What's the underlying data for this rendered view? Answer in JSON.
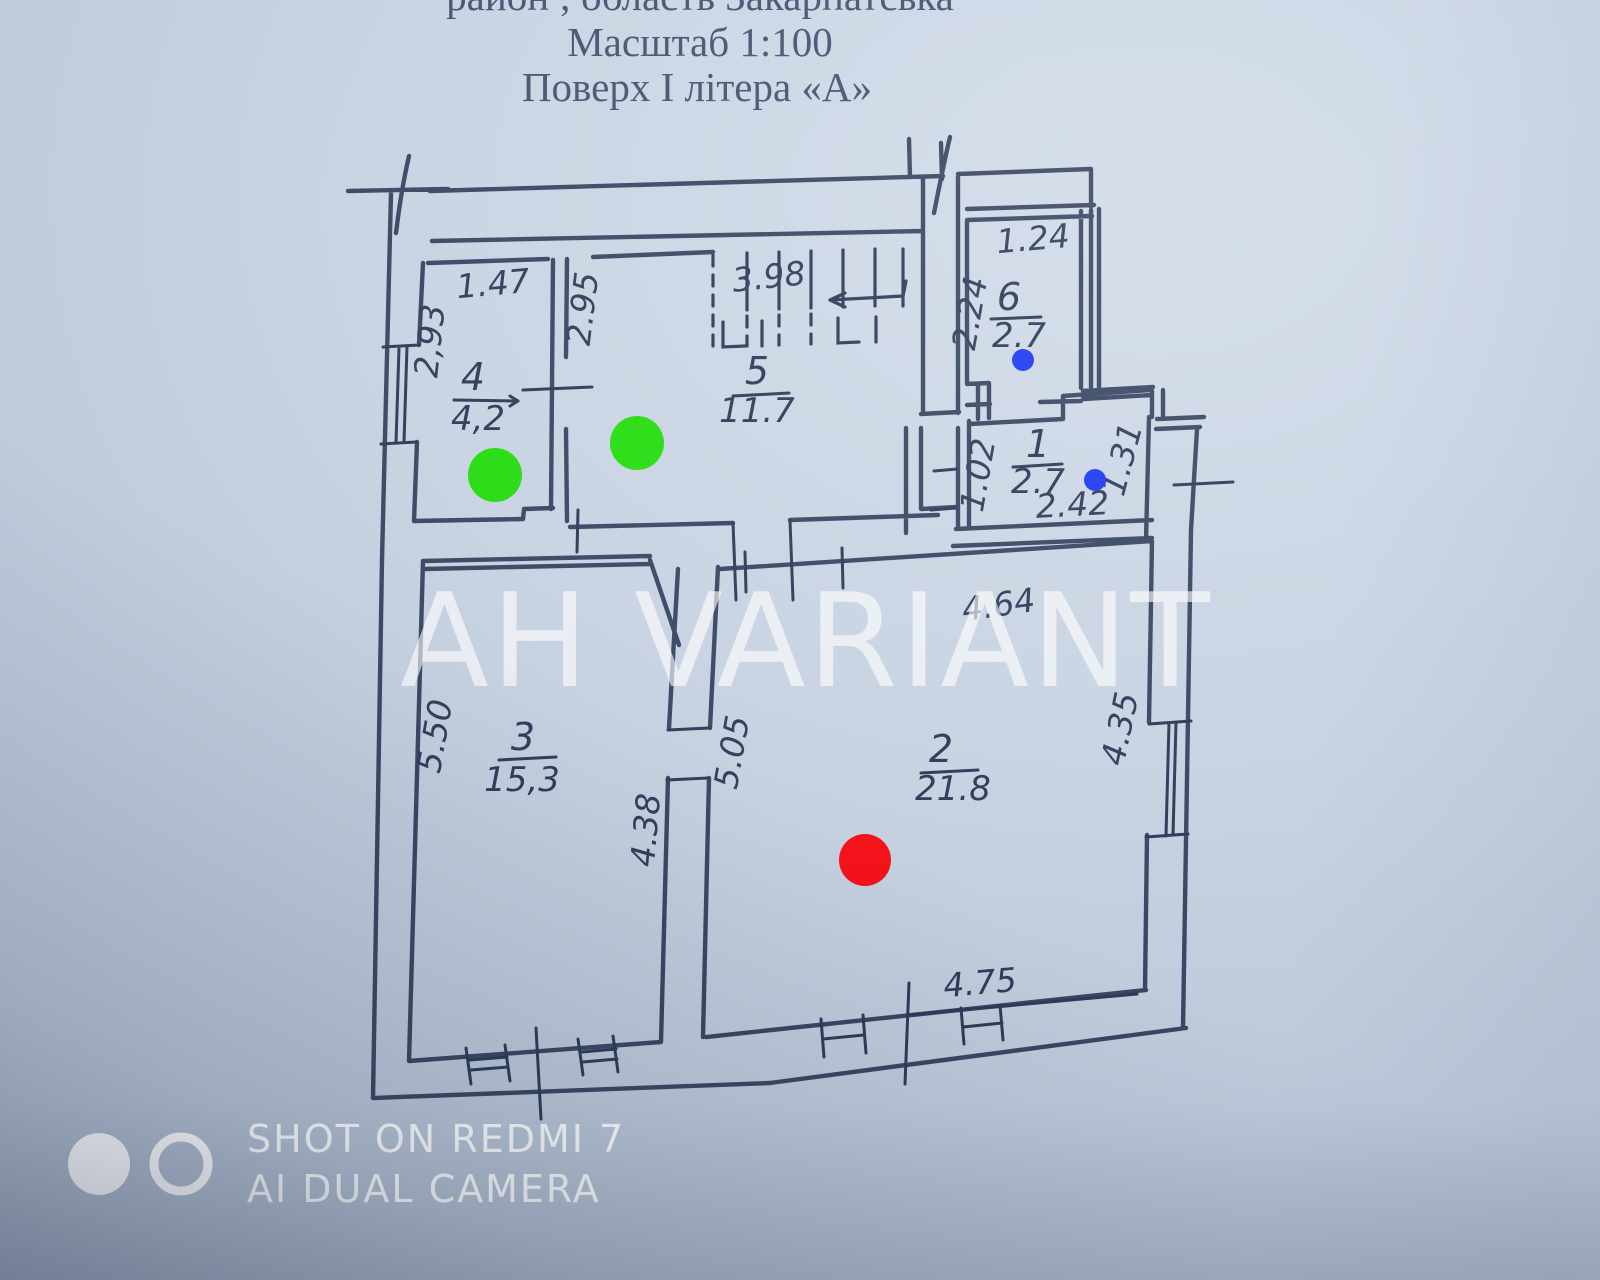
{
  "header": {
    "line1": "район      ;      область Закарпатська",
    "line2": "Масштаб 1:100",
    "line3": "Поверх  І  літера «А»"
  },
  "plan": {
    "rooms": [
      {
        "number": "1",
        "area": "2.7",
        "dims": {
          "left": "1.02",
          "bottom": "2.42",
          "right": "1.31"
        }
      },
      {
        "number": "2",
        "area": "21.8",
        "dims": {
          "top": "4.64",
          "left": "5.05",
          "right": "4.35",
          "bottom": "4.75"
        }
      },
      {
        "number": "3",
        "area": "15,3",
        "dims": {
          "left": "5.50",
          "right": "4.38"
        }
      },
      {
        "number": "4",
        "area": "4,2",
        "dims": {
          "top": "1.47",
          "left": "2,93"
        }
      },
      {
        "number": "5",
        "area": "11.7",
        "dims": {
          "top": "3.98",
          "left": "2.95"
        }
      },
      {
        "number": "6",
        "area": "2.7",
        "dims": {
          "top": "1.24",
          "left": "2.24"
        }
      }
    ],
    "markers": [
      {
        "name": "green-dot-room-4",
        "hex": "#25dc10"
      },
      {
        "name": "green-dot-room-5",
        "hex": "#25dc10"
      },
      {
        "name": "blue-dot-room-6",
        "hex": "#1c3af2"
      },
      {
        "name": "blue-dot-room-1",
        "hex": "#1c3af2"
      },
      {
        "name": "red-dot-room-2",
        "hex": "#f50f16"
      }
    ]
  },
  "watermarks": {
    "agency": "AH VARIANT",
    "camera_line1": "SHOT ON REDMI 7",
    "camera_line2": "AI DUAL CAMERA"
  },
  "colors": {
    "ink": "#2c3b58",
    "paper": "#c3cedd",
    "header_text": "#3a4a68",
    "watermark_fill": "rgba(255,255,255,0.62)",
    "camera_text": "#ffffff"
  }
}
